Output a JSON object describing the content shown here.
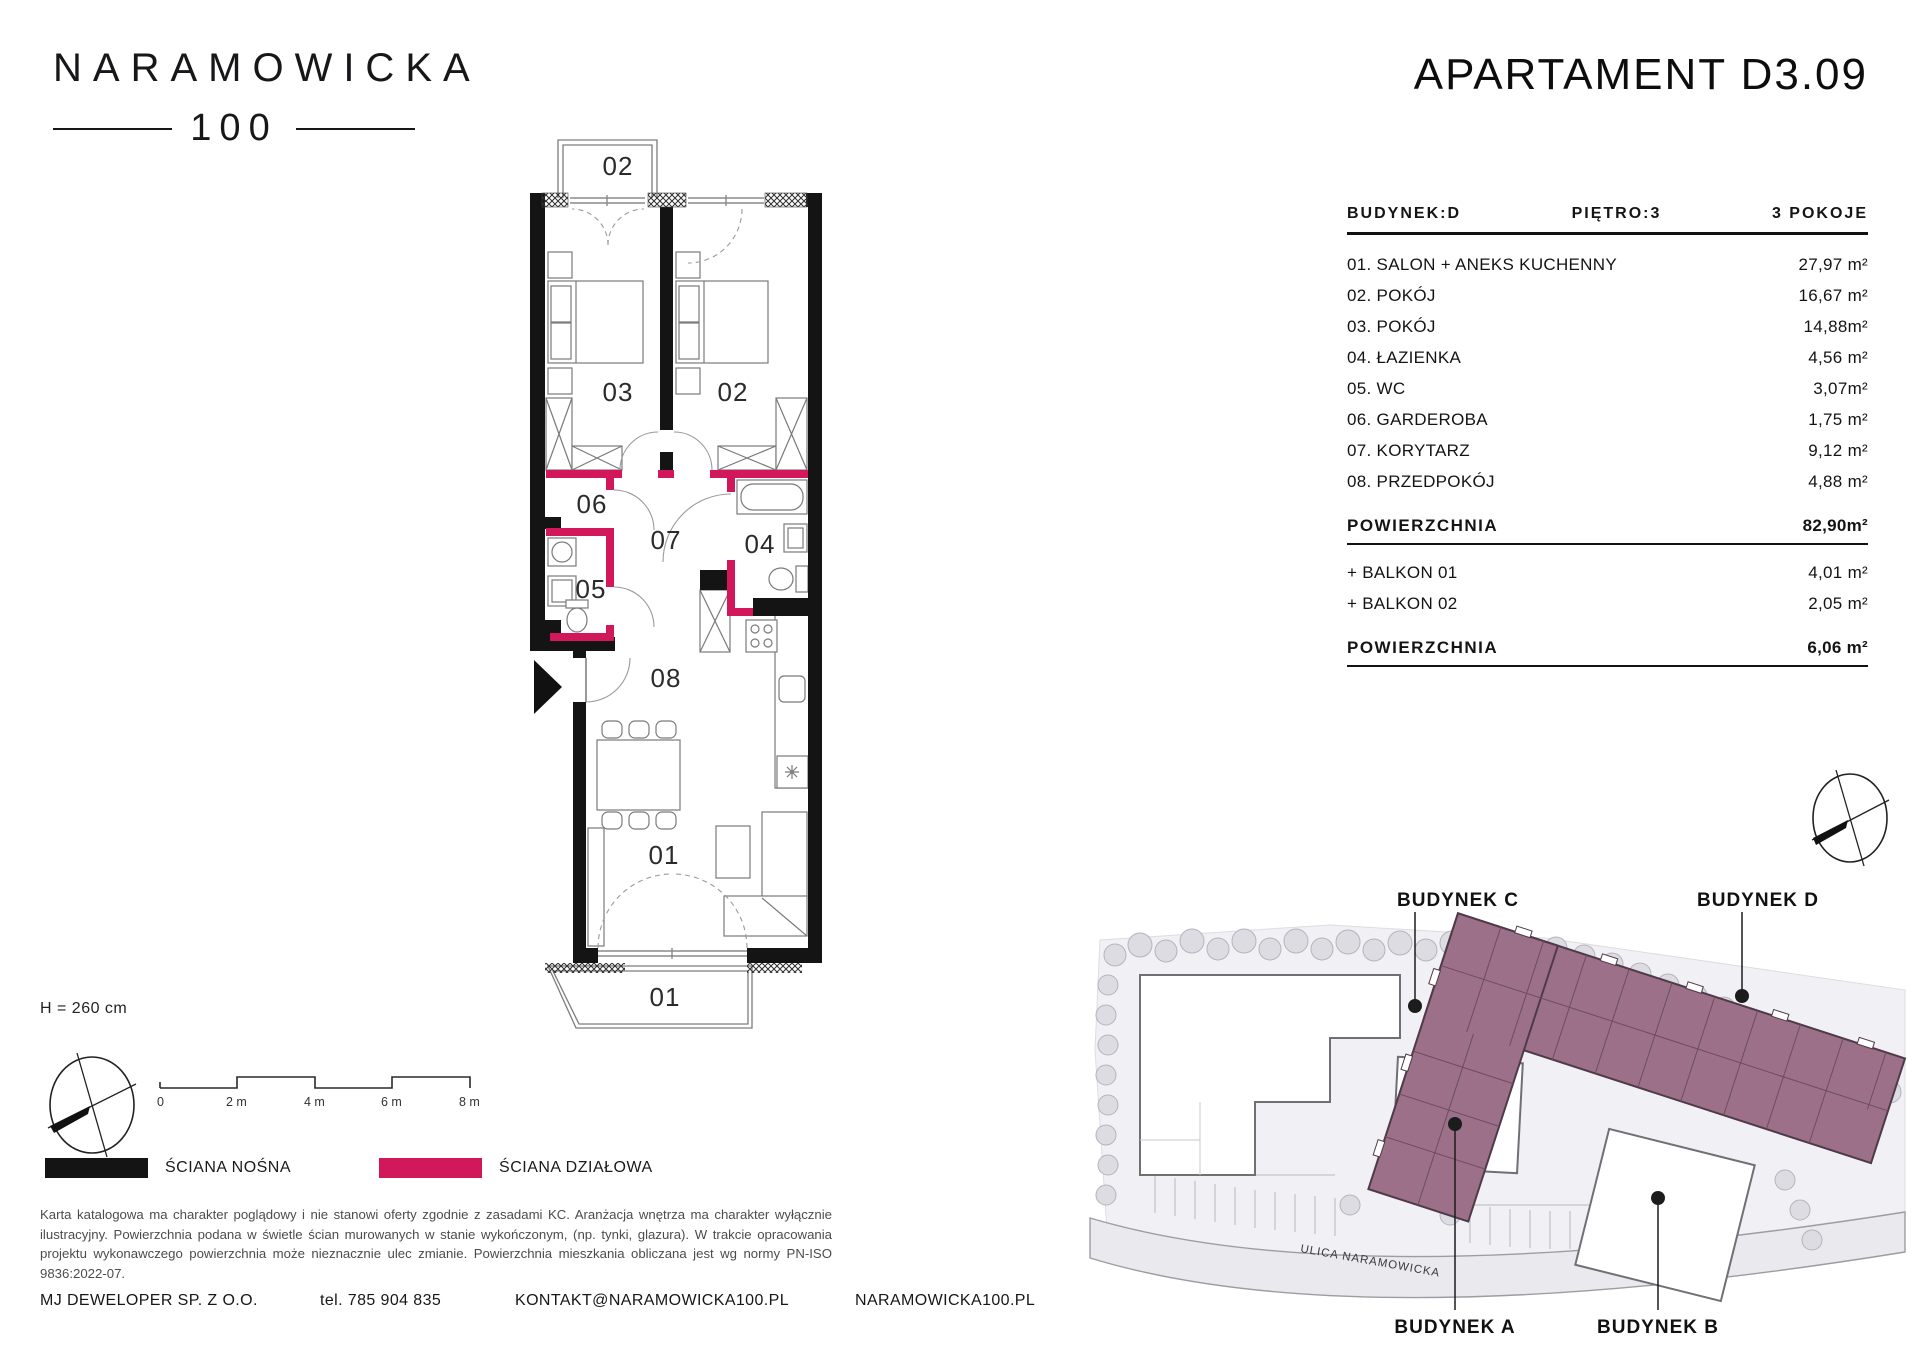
{
  "brand": {
    "line1": "NARAMOWICKA",
    "line2": "100"
  },
  "header": {
    "title": "APARTAMENT D3.09"
  },
  "unit": {
    "building": "BUDYNEK:D",
    "floor": "PIĘTRO:3",
    "rooms_count": "3 POKOJE",
    "rows": [
      {
        "label": "01. SALON + ANEKS KUCHENNY",
        "area": "27,97 m²"
      },
      {
        "label": "02. POKÓJ",
        "area": "16,67 m²"
      },
      {
        "label": "03. POKÓJ",
        "area": "14,88m²"
      },
      {
        "label": "04. ŁAZIENKA",
        "area": "4,56 m²"
      },
      {
        "label": "05. WC",
        "area": "3,07m²"
      },
      {
        "label": "06. GARDEROBA",
        "area": "1,75 m²"
      },
      {
        "label": "07. KORYTARZ",
        "area": "9,12 m²"
      },
      {
        "label": "08. PRZEDPOKÓJ",
        "area": "4,88 m²"
      }
    ],
    "total": {
      "label": "POWIERZCHNIA",
      "area": "82,90m²"
    },
    "balconies": [
      {
        "label": "+ BALKON 01",
        "area": "4,01 m²"
      },
      {
        "label": "+ BALKON 02",
        "area": "2,05 m²"
      }
    ],
    "balcony_total": {
      "label": "POWIERZCHNIA",
      "area": "6,06 m²"
    }
  },
  "plan": {
    "rooms": {
      "r01": "01",
      "r02": "02",
      "r03": "03",
      "r04": "04",
      "r05": "05",
      "r06": "06",
      "r07": "07",
      "r08": "08"
    },
    "balconies": {
      "b01": "01",
      "b02": "02"
    },
    "ceiling_height": "H = 260 cm",
    "scale": {
      "t0": "0",
      "t2": "2 m",
      "t4": "4 m",
      "t6": "6 m",
      "t8": "8 m"
    }
  },
  "legend": {
    "load_bearing": {
      "label": "ŚCIANA NOŚNA",
      "color": "#141414"
    },
    "partition": {
      "label": "ŚCIANA DZIAŁOWA",
      "color": "#d2175a"
    }
  },
  "site": {
    "building_c": "BUDYNEK C",
    "building_d": "BUDYNEK D",
    "building_a": "BUDYNEK A",
    "building_b": "BUDYNEK B",
    "street": "ULICA NARAMOWICKA",
    "highlight_color": "#9c7089"
  },
  "disclaimer": "Karta katalogowa ma charakter poglądowy i nie stanowi oferty zgodnie z zasadami KC. Aranżacja wnętrza ma charakter wyłącznie ilustracyjny. Powierzchnia podana w świetle ścian murowanych w stanie wykończonym, (np. tynki, glazura). W trakcie opracowania projektu wykonawczego powierzchnia może nieznacznie ulec zmianie. Powierzchnia mieszkania obliczana jest wg normy PN-ISO 9836:2022-07.",
  "footer": {
    "company": "MJ DEWELOPER SP. Z O.O.",
    "phone": "tel. 785 904 835",
    "email": "KONTAKT@NARAMOWICKA100.PL",
    "website": "NARAMOWICKA100.PL"
  }
}
